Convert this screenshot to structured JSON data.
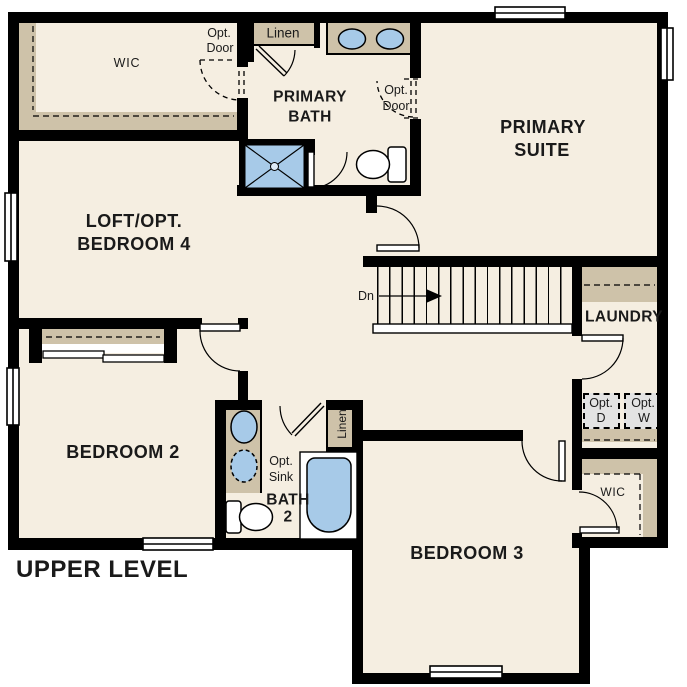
{
  "plan": {
    "title": "UPPER LEVEL",
    "rooms": {
      "loft": {
        "line1": "LOFT/OPT.",
        "line2": "BEDROOM 4"
      },
      "primary_suite": {
        "line1": "PRIMARY",
        "line2": "SUITE"
      },
      "primary_bath": {
        "line1": "PRIMARY",
        "line2": "BATH"
      },
      "bedroom2": {
        "label": "BEDROOM 2"
      },
      "bedroom3": {
        "label": "BEDROOM 3"
      },
      "bath2": {
        "line1": "BATH",
        "line2": "2"
      },
      "laundry": {
        "label": "LAUNDRY"
      },
      "primary_wic": {
        "label": "WIC"
      },
      "bedroom3_wic": {
        "label": "WIC"
      }
    },
    "closets": {
      "primary_linen": {
        "label": "Linen"
      },
      "bath2_linen": {
        "label": "Linen"
      }
    },
    "options": {
      "wic_opt_door": {
        "line1": "Opt.",
        "line2": "Door"
      },
      "suite_opt_door": {
        "line1": "Opt.",
        "line2": "Door"
      },
      "opt_sink": {
        "line1": "Opt.",
        "line2": "Sink"
      },
      "opt_dryer": {
        "line1": "Opt.",
        "line2": "D"
      },
      "opt_washer": {
        "line1": "Opt.",
        "line2": "W"
      }
    },
    "stairs": {
      "direction": "Dn"
    },
    "colors": {
      "floor": "#f5eee1",
      "wall": "#000000",
      "casework": "#cec2a9",
      "fixture": "#a7cae8",
      "appliance": "#e3e3e3",
      "background": "#ffffff"
    }
  }
}
